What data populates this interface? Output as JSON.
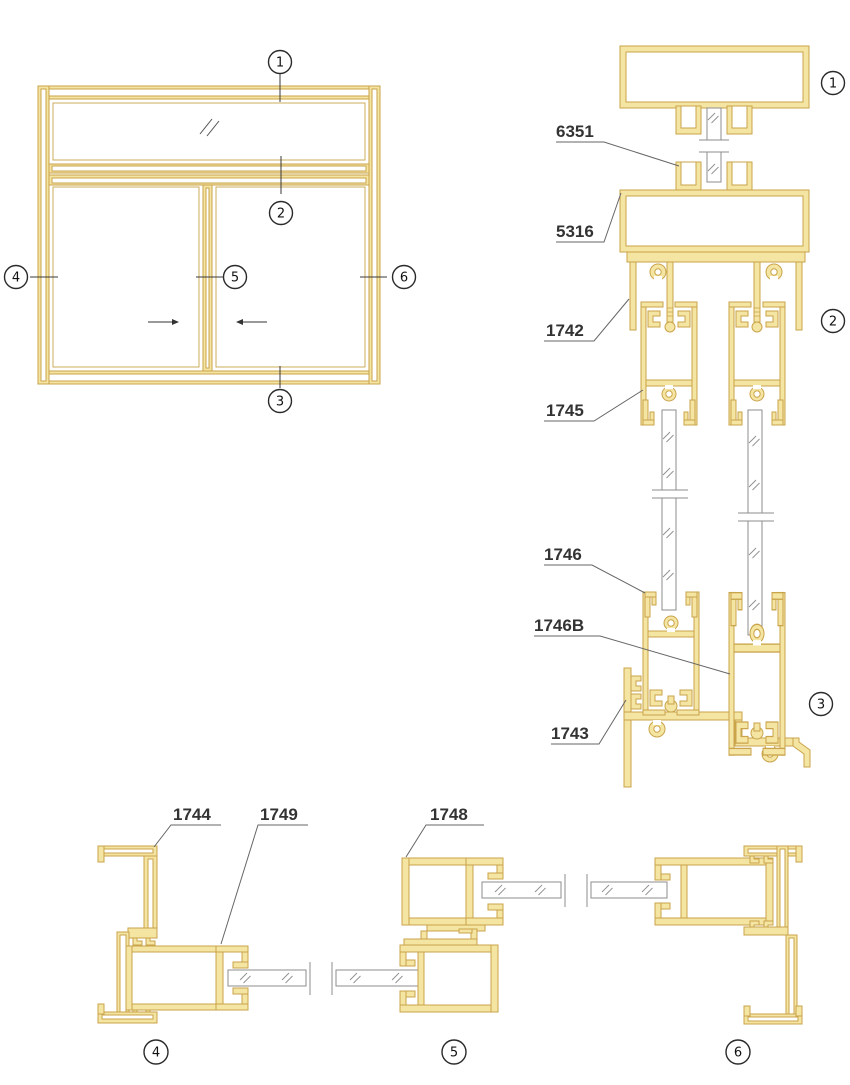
{
  "parts": {
    "p6351": "6351",
    "p5316": "5316",
    "p1742": "1742",
    "p1745": "1745",
    "p1746": "1746",
    "p1746b": "1746B",
    "p1743": "1743",
    "p1744": "1744",
    "p1749": "1749",
    "p1748": "1748"
  },
  "markers": {
    "m1": "1",
    "m2": "2",
    "m3": "3",
    "m4": "4",
    "m5": "5",
    "m6": "6"
  },
  "colors": {
    "profile_fill": "#F5E5A3",
    "profile_stroke": "#C9A44B",
    "glass_stroke": "#8E8E8E",
    "line": "#666666",
    "text": "#333333"
  }
}
